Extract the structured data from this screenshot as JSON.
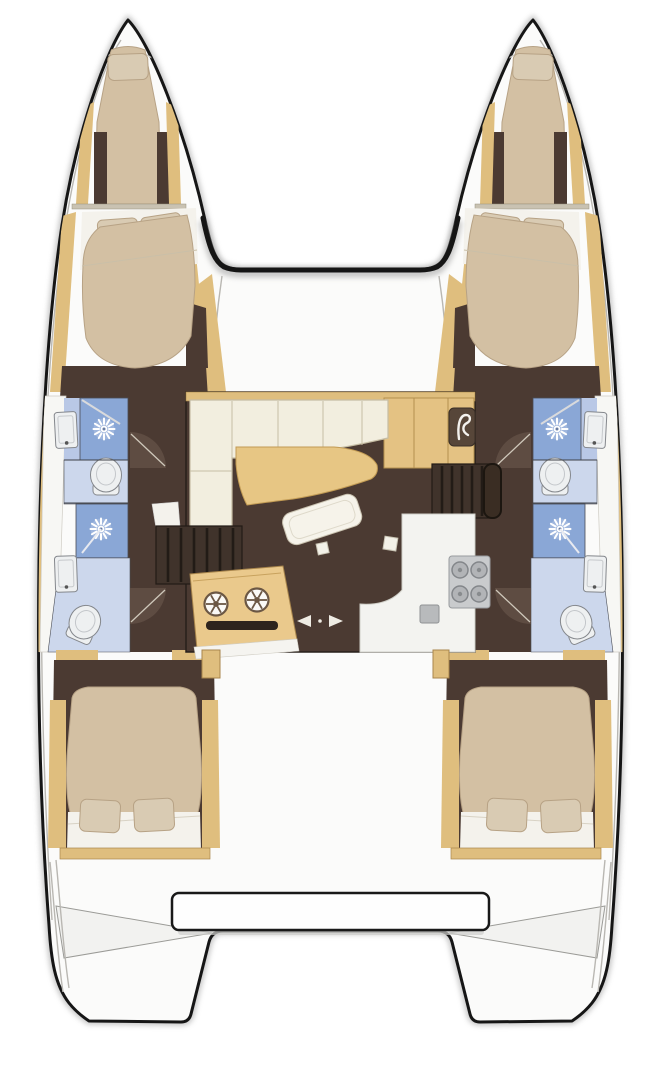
{
  "diagram": {
    "type": "catamaran-floor-plan",
    "view": "top-down",
    "port_hull": {
      "forepeak": {
        "items": [
          "single-berth",
          "pillow"
        ]
      },
      "forward_cabin": {
        "items": [
          "double-berth",
          "pillow",
          "pillow"
        ]
      },
      "forward_head": {
        "items": [
          "washbasin",
          "shower-stall",
          "toilet"
        ]
      },
      "aft_head": {
        "items": [
          "washbasin",
          "shower-stall",
          "toilet"
        ]
      },
      "aft_cabin": {
        "items": [
          "double-berth",
          "pillow",
          "pillow"
        ]
      },
      "stern": {
        "items": [
          "swim-platform-steps"
        ]
      }
    },
    "starboard_hull": {
      "mirrored_from": "port_hull",
      "forepeak": {
        "items": [
          "single-berth",
          "pillow"
        ]
      },
      "forward_cabin": {
        "items": [
          "double-berth",
          "pillow",
          "pillow"
        ]
      },
      "forward_head": {
        "items": [
          "washbasin",
          "shower-stall",
          "toilet"
        ]
      },
      "aft_head": {
        "items": [
          "washbasin",
          "shower-stall",
          "toilet"
        ]
      },
      "aft_cabin": {
        "items": [
          "double-berth",
          "pillow",
          "pillow"
        ]
      },
      "stern": {
        "items": [
          "swim-platform-steps"
        ]
      }
    },
    "bridgedeck": {
      "foredeck": {
        "items": [
          "forward-crossbeam"
        ]
      },
      "saloon": {
        "items": [
          "l-shaped-sofa",
          "curved-cocktail-table",
          "lounge-pad",
          "sideboard-with-faucet",
          "stairs-to-port-hull",
          "stairs-to-starboard-hull"
        ],
        "galley": {
          "items": [
            "double-sink-unit",
            "front-slot",
            "four-burner-stove",
            "aux-sink",
            "l-shaped-counter"
          ]
        }
      },
      "cockpit": {
        "items": [
          "transverse-bench-seat",
          "sliding-door-arrows"
        ]
      }
    },
    "counts": {
      "double_cabins": 4,
      "forepeak_berths": 2,
      "toilets": 4,
      "showers": 4,
      "washbasins": 4,
      "stove_burners": 4,
      "galley_sinks": 2
    }
  },
  "icons": [
    {
      "name": "shower-head-icon",
      "glyph": "white sunburst"
    },
    {
      "name": "washbasin-icon",
      "glyph": "white rectangle with drain dot"
    },
    {
      "name": "toilet-icon",
      "glyph": "white oval bowl with cistern"
    },
    {
      "name": "faucet-icon",
      "glyph": "white curved tap on dark square"
    },
    {
      "name": "sink-drain-icon",
      "glyph": "spoked circle"
    },
    {
      "name": "stove-burner-icon",
      "glyph": "gray circle"
    },
    {
      "name": "sliding-door-arrow-icons",
      "glyph": "left and right triangles"
    }
  ],
  "colors": {
    "background": "#ffffff",
    "hull_outline": "#161616",
    "hull_shadow": "#ababab",
    "deck_white": "#fbfbfa",
    "deck_line": "#b9b7b2",
    "wood_trim": "#dfbe7e",
    "wood_dark": "#a8854c",
    "floor_brown": "#4b3a32",
    "door_wedge": "#5e4c42",
    "mattress": "#d3c0a3",
    "mattress_edge": "#b7a285",
    "pillow": "#d9cbb3",
    "sheet_white": "#f4f2ec",
    "sofa_cream": "#f2eedf",
    "sofa_line": "#c6bda4",
    "table_wood": "#e7c684",
    "shower_blue": "#8aa7d6",
    "tile_blue": "#b9c8e6",
    "bath_floor_blue": "#ccd7ec",
    "fixture_white": "#eef0f1",
    "fixture_line": "#84878c",
    "steel_gray": "#c9cbcd",
    "galley_wood": "#eac98c"
  }
}
